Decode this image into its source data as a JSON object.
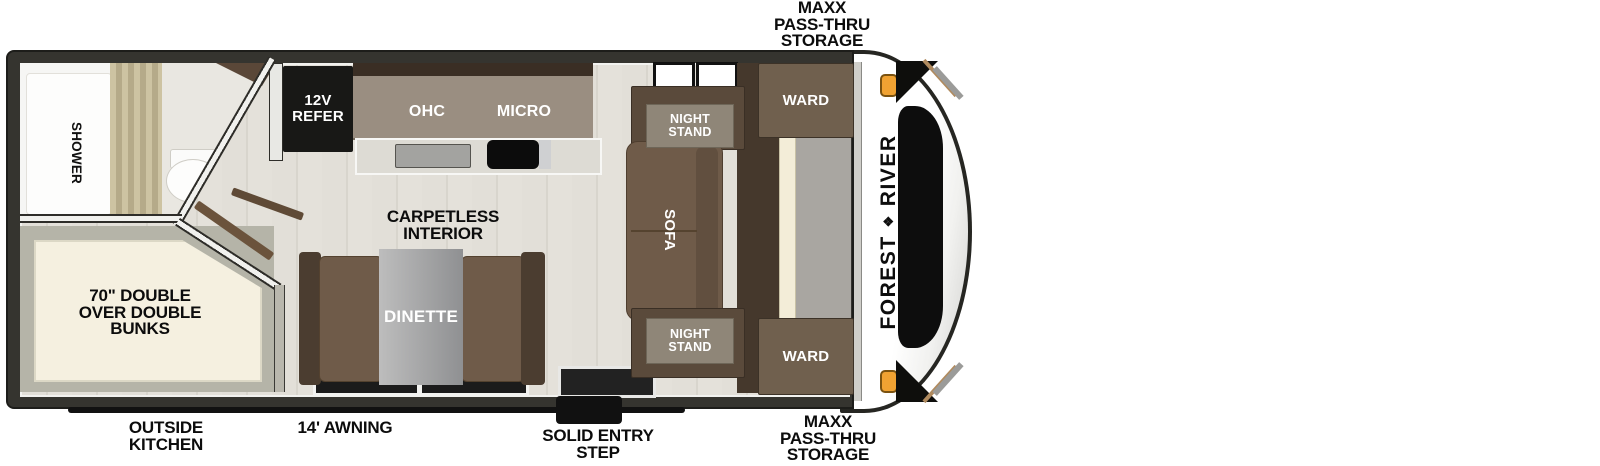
{
  "palette": {
    "wall_dark": "#34332e",
    "floor_plank": "#e2dfd8",
    "furniture_brown": "#6f5b49",
    "furniture_dark_brown": "#4b3d30",
    "cabinet_taupe": "#9a8e81",
    "nightstand_panel_gray": "#8f8678",
    "bunk_cream": "#f5f0e0",
    "curtain_tan": "#c4b997",
    "table_gray": "#a7a7a7",
    "marker_light_amber": "#f0a232",
    "graphic_stripe_tan": "#b08a5e",
    "label_black": "#0c0c0c",
    "label_white": "#ffffff"
  },
  "exterior_labels": {
    "front_storage_top": [
      "MAXX",
      "PASS-THRU",
      "STORAGE"
    ],
    "front_storage_bottom": [
      "MAXX",
      "PASS-THRU",
      "STORAGE"
    ],
    "outside_kitchen": [
      "OUTSIDE",
      "KITCHEN"
    ],
    "awning": "14' AWNING",
    "entry_step": [
      "SOLID ENTRY",
      "STEP"
    ]
  },
  "brand": {
    "word1": "FOREST",
    "word2": "RIVER",
    "logo_glyph": "❖"
  },
  "bathroom": {
    "shower": "SHOWER"
  },
  "bunk_room": {
    "bunks": [
      "70\" DOUBLE",
      "OVER DOUBLE",
      "BUNKS"
    ]
  },
  "kitchen": {
    "refrigerator": [
      "12V",
      "REFER"
    ],
    "overhead_cabinet": "OHC",
    "microwave": "MICRO"
  },
  "living_area": {
    "floor_note": [
      "CARPETLESS",
      "INTERIOR"
    ],
    "dinette": "DINETTE",
    "sofa": "SOFA",
    "night_stand_top": [
      "NIGHT",
      "STAND"
    ],
    "night_stand_bottom": [
      "NIGHT",
      "STAND"
    ],
    "wardrobe_top": "WARD",
    "wardrobe_bottom": "WARD"
  }
}
